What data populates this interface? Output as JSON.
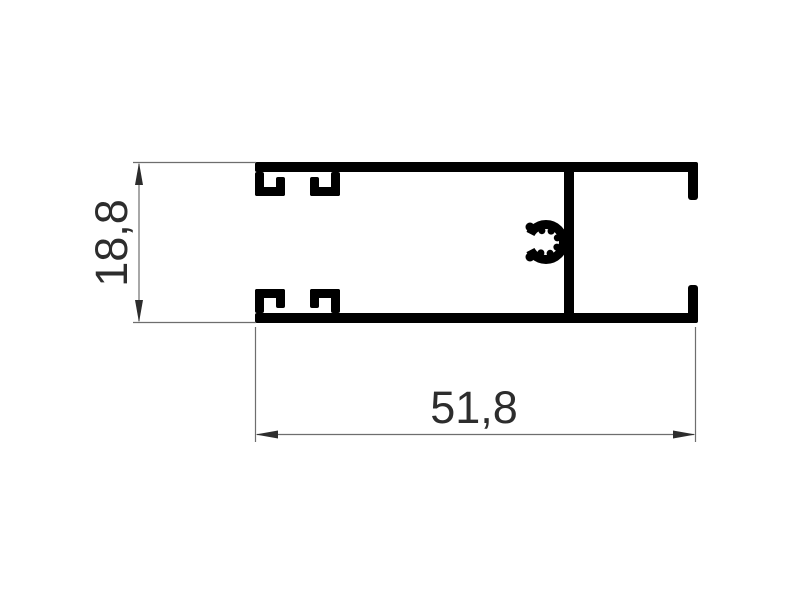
{
  "drawing": {
    "background_color": "#ffffff",
    "profile_color": "#000000",
    "dimension_line_color": "#6e6e6e",
    "dimension_text_color": "#2d2d2d",
    "dimensions": {
      "height": {
        "label": "18,8",
        "orientation": "vertical"
      },
      "width": {
        "label": "51,8",
        "orientation": "horizontal"
      }
    }
  }
}
